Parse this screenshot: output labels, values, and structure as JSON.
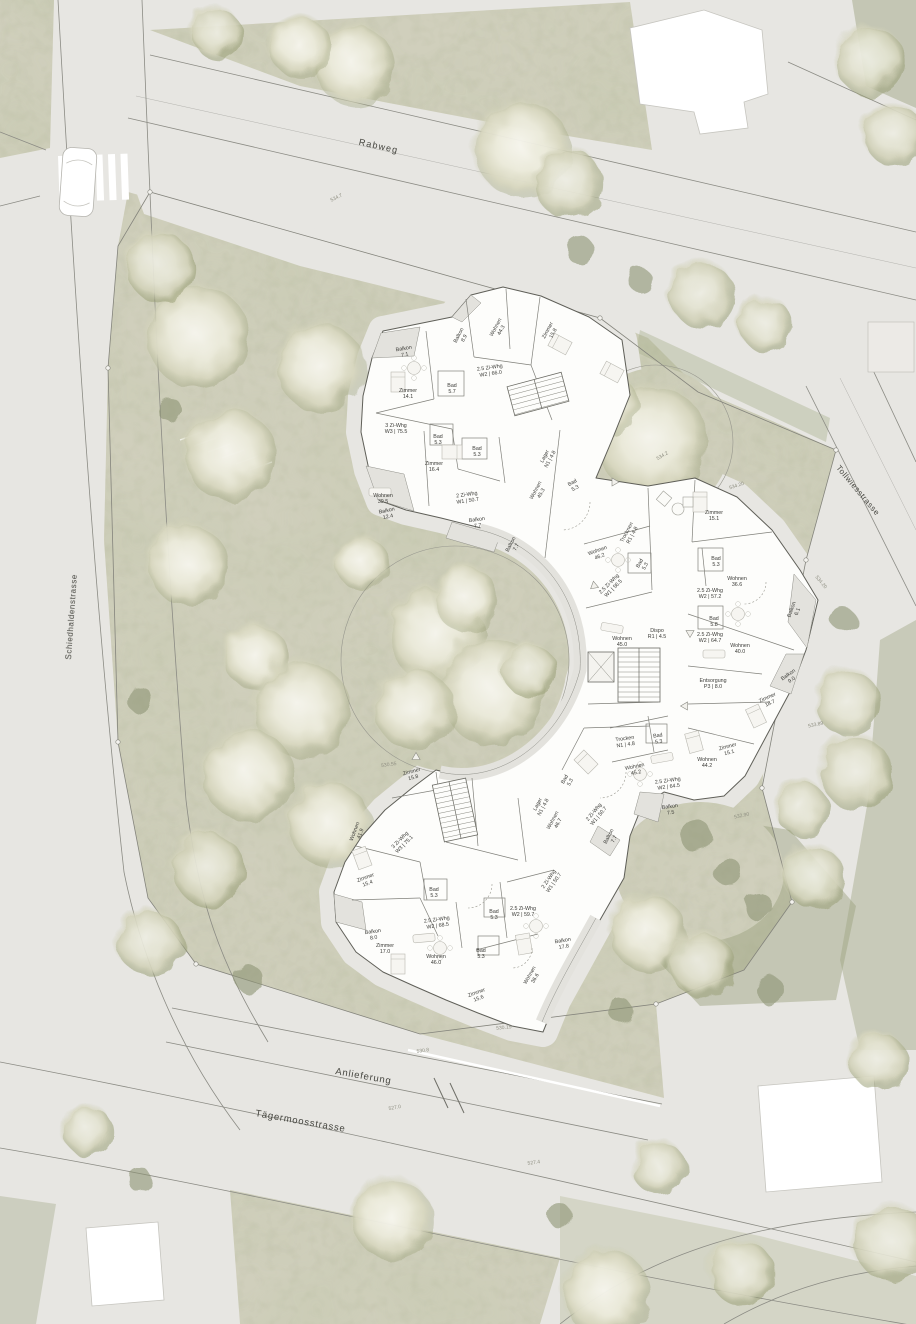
{
  "streets": {
    "rabweg": "Rabweg",
    "schiedhaldenstrasse": "Schiedhaldenstrasse",
    "tollwiesstrasse": "Tollwiesstrasse",
    "anlieferung": "Anlieferung",
    "taegermoosstrasse": "Tägermoosstrasse"
  },
  "rooms": [
    {
      "l1": "Balkon",
      "l2": "7.1",
      "x": 404,
      "y": 350,
      "r": -10
    },
    {
      "l1": "Balkon",
      "l2": "8.9",
      "x": 460,
      "y": 336,
      "r": -62
    },
    {
      "l1": "Wohnen",
      "l2": "44.3",
      "x": 497,
      "y": 328,
      "r": -62
    },
    {
      "l1": "Zimmer",
      "l2": "15.8",
      "x": 549,
      "y": 331,
      "r": -62
    },
    {
      "l1": "2.5 Zi-Whg",
      "l2": "W2 | 66.0",
      "x": 490,
      "y": 369,
      "r": -8
    },
    {
      "l1": "Zimmer",
      "l2": "14.1",
      "x": 408,
      "y": 392,
      "r": 0
    },
    {
      "l1": "Bad",
      "l2": "5.7",
      "x": 452,
      "y": 387,
      "r": 0
    },
    {
      "l1": "3 Zi-Whg",
      "l2": "W3 | 75.5",
      "x": 396,
      "y": 427,
      "r": 0
    },
    {
      "l1": "Bad",
      "l2": "5.3",
      "x": 438,
      "y": 438,
      "r": 0
    },
    {
      "l1": "Bad",
      "l2": "5.3",
      "x": 477,
      "y": 450,
      "r": 0
    },
    {
      "l1": "Zimmer",
      "l2": "16.4",
      "x": 434,
      "y": 465,
      "r": 0
    },
    {
      "l1": "Lager",
      "l2": "N1 | 4.8",
      "x": 546,
      "y": 457,
      "r": -62
    },
    {
      "l1": "Wohnen",
      "l2": "39.5",
      "x": 383,
      "y": 497,
      "r": 0
    },
    {
      "l1": "Balkon",
      "l2": "12.4",
      "x": 387,
      "y": 512,
      "r": -12
    },
    {
      "l1": "2 Zi-Whg",
      "l2": "W1 | 50.7",
      "x": 467,
      "y": 496,
      "r": -8
    },
    {
      "l1": "Balkon",
      "l2": "7.7",
      "x": 477,
      "y": 521,
      "r": -8
    },
    {
      "l1": "Balkon",
      "l2": "7.7",
      "x": 512,
      "y": 545,
      "r": -62
    },
    {
      "l1": "Wohnen",
      "l2": "45.3",
      "x": 537,
      "y": 491,
      "r": -62
    },
    {
      "l1": "Bad",
      "l2": "5.3",
      "x": 573,
      "y": 484,
      "r": -28
    },
    {
      "l1": "Wohnen",
      "l2": "46.2",
      "x": 598,
      "y": 552,
      "r": -20
    },
    {
      "l1": "Trocknen",
      "l2": "R1 | 4.8",
      "x": 628,
      "y": 533,
      "r": -62
    },
    {
      "l1": "Bad",
      "l2": "5.3",
      "x": 641,
      "y": 564,
      "r": -62
    },
    {
      "l1": "2.5 Zi-Whg",
      "l2": "W1 | 56.5",
      "x": 610,
      "y": 585,
      "r": -45
    },
    {
      "l1": "Wohnen",
      "l2": "45.0",
      "x": 622,
      "y": 640,
      "r": 0
    },
    {
      "l1": "Dispo",
      "l2": "R1 | 4.5",
      "x": 657,
      "y": 632,
      "r": 0
    },
    {
      "l1": "Zimmer",
      "l2": "15.1",
      "x": 714,
      "y": 514,
      "r": 0
    },
    {
      "l1": "Bad",
      "l2": "5.3",
      "x": 716,
      "y": 560,
      "r": 0
    },
    {
      "l1": "Wohnen",
      "l2": "36.6",
      "x": 737,
      "y": 580,
      "r": 0
    },
    {
      "l1": "2.5 Zi-Whg",
      "l2": "W2 | 57.2",
      "x": 710,
      "y": 592,
      "r": 0
    },
    {
      "l1": "Bad",
      "l2": "5.8",
      "x": 714,
      "y": 620,
      "r": 0
    },
    {
      "l1": "Balkon",
      "l2": "6.1",
      "x": 793,
      "y": 610,
      "r": -70
    },
    {
      "l1": "2.5 Zi-Whg",
      "l2": "W2 | 64.7",
      "x": 710,
      "y": 636,
      "r": 0
    },
    {
      "l1": "Wohnen",
      "l2": "40.0",
      "x": 740,
      "y": 647,
      "r": 0
    },
    {
      "l1": "Entsorgung",
      "l2": "P3 | 8.0",
      "x": 713,
      "y": 682,
      "r": 0
    },
    {
      "l1": "Balkon",
      "l2": "9.0",
      "x": 789,
      "y": 676,
      "r": -35
    },
    {
      "l1": "Zimmer",
      "l2": "18.7",
      "x": 768,
      "y": 699,
      "r": -25
    },
    {
      "l1": "Zimmer",
      "l2": "15.1",
      "x": 728,
      "y": 748,
      "r": -15
    },
    {
      "l1": "Wohnen",
      "l2": "44.2",
      "x": 707,
      "y": 761,
      "r": 0
    },
    {
      "l1": "Trocken",
      "l2": "N1 | 4.8",
      "x": 625,
      "y": 740,
      "r": -8
    },
    {
      "l1": "Bad",
      "l2": "5.3",
      "x": 658,
      "y": 737,
      "r": -8
    },
    {
      "l1": "Wohnen",
      "l2": "45.2",
      "x": 635,
      "y": 768,
      "r": -12
    },
    {
      "l1": "2.5 Zi-Whg",
      "l2": "W2 | 64.5",
      "x": 668,
      "y": 782,
      "r": -8
    },
    {
      "l1": "Balkon",
      "l2": "7.5",
      "x": 670,
      "y": 808,
      "r": -8
    },
    {
      "l1": "Bad",
      "l2": "5.3",
      "x": 566,
      "y": 780,
      "r": -62
    },
    {
      "l1": "2 Zi-Whg",
      "l2": "W1 | 50.7",
      "x": 595,
      "y": 813,
      "r": -50
    },
    {
      "l1": "Balkon",
      "l2": "7.7",
      "x": 610,
      "y": 837,
      "r": -62
    },
    {
      "l1": "Wohnen",
      "l2": "41.9",
      "x": 356,
      "y": 832,
      "r": -70
    },
    {
      "l1": "Zimmer",
      "l2": "15.8",
      "x": 412,
      "y": 773,
      "r": -15
    },
    {
      "l1": "3 Zi-Whg",
      "l2": "W3 | 75.1",
      "x": 401,
      "y": 841,
      "r": -45
    },
    {
      "l1": "Zimmer",
      "l2": "15.4",
      "x": 366,
      "y": 879,
      "r": -20
    },
    {
      "l1": "Bad",
      "l2": "5.3",
      "x": 434,
      "y": 891,
      "r": 0
    },
    {
      "l1": "2.5 Zi-Whg",
      "l2": "W2 | 68.5",
      "x": 437,
      "y": 921,
      "r": -8
    },
    {
      "l1": "Bad",
      "l2": "5.3",
      "x": 494,
      "y": 913,
      "r": 0
    },
    {
      "l1": "2.5 Zi-Whg",
      "l2": "W2 | 59.7",
      "x": 523,
      "y": 910,
      "r": 0
    },
    {
      "l1": "Balkon",
      "l2": "8.0",
      "x": 373,
      "y": 933,
      "r": -8
    },
    {
      "l1": "Zimmer",
      "l2": "17.0",
      "x": 385,
      "y": 947,
      "r": 0
    },
    {
      "l1": "Wohnen",
      "l2": "46.0",
      "x": 436,
      "y": 958,
      "r": 0
    },
    {
      "l1": "Bad",
      "l2": "5.3",
      "x": 481,
      "y": 952,
      "r": 0
    },
    {
      "l1": "Zimmer",
      "l2": "15.6",
      "x": 477,
      "y": 994,
      "r": -20
    },
    {
      "l1": "Balkon",
      "l2": "17.8",
      "x": 563,
      "y": 942,
      "r": -10
    },
    {
      "l1": "Wohnen",
      "l2": "36.6",
      "x": 531,
      "y": 976,
      "r": -60
    },
    {
      "l1": "Lager",
      "l2": "N1 | 4.8",
      "x": 539,
      "y": 805,
      "r": -62
    },
    {
      "l1": "Wohnen",
      "l2": "46.7",
      "x": 554,
      "y": 821,
      "r": -62
    },
    {
      "l1": "2 Zi-Whg",
      "l2": "W1 | 50.7",
      "x": 550,
      "y": 880,
      "r": -55
    }
  ],
  "elevations": [
    {
      "t": "534.7",
      "x": 337,
      "y": 199,
      "r": -26
    },
    {
      "t": "534.20",
      "x": 737,
      "y": 487,
      "r": -18
    },
    {
      "t": "534.2",
      "x": 663,
      "y": 457,
      "r": -30
    },
    {
      "t": "534.20",
      "x": 820,
      "y": 583,
      "r": 50
    },
    {
      "t": "533.89",
      "x": 816,
      "y": 726,
      "r": -12
    },
    {
      "t": "532.90",
      "x": 742,
      "y": 817,
      "r": -12
    },
    {
      "t": "530.55",
      "x": 389,
      "y": 766,
      "r": -8
    },
    {
      "t": "530.8",
      "x": 423,
      "y": 1052,
      "r": -9
    },
    {
      "t": "527.0",
      "x": 395,
      "y": 1109,
      "r": -10
    },
    {
      "t": "530.15",
      "x": 504,
      "y": 1029,
      "r": -6
    },
    {
      "t": "527.4",
      "x": 534,
      "y": 1164,
      "r": -8
    }
  ],
  "colors": {
    "paving": "#e7e6e2",
    "vegetation_base": "#d0cfbc",
    "vegetation_dark": "#9aa07d",
    "building_fill": "#fdfdfb",
    "wall_line": "#5f5f58",
    "balcony_fill": "#e3e2dd",
    "label_text": "#3a3a36",
    "elevation_text": "#8f8f82"
  }
}
